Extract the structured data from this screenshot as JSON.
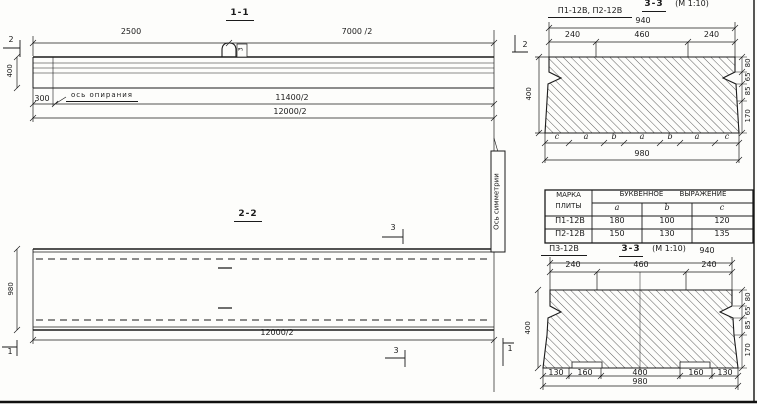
{
  "colors": {
    "ink": "#1b1b1b",
    "paper": "#fdfdfb"
  },
  "s11": {
    "title": "1-1",
    "marker_left": "2",
    "marker_right": "2",
    "dim_2500": "2500",
    "dim_7000": "7000 /2",
    "loop_tag": "3",
    "dim_400": "400",
    "dim_300": "300",
    "bearing_label": "ось опирания",
    "dim_11400": "11400/2",
    "dim_12000": "12000/2"
  },
  "s22": {
    "title": "2-2",
    "marker_3_top": "3",
    "marker_3_bottom": "3",
    "marker_1_left": "1",
    "marker_1_right": "1",
    "dim_980": "980",
    "dim_12000": "12000/2",
    "symmetry_label": "Ось симметрии"
  },
  "s33a": {
    "label": "П1-12В, П2-12В",
    "title": "3-3",
    "scale": "(М 1:10)",
    "dim_940": "940",
    "top_dims": [
      "240",
      "460",
      "240"
    ],
    "dim_400": "400",
    "right_dims": [
      "80",
      "65",
      "85",
      "170"
    ],
    "letters": [
      "c",
      "a",
      "b",
      "a",
      "b",
      "a",
      "c"
    ],
    "dim_980": "980"
  },
  "table": {
    "h_mark_1": "МАРКА",
    "h_mark_2": "ПЛИТЫ",
    "h_expr": "БУКВЕННОЕ ВЫРАЖЕНИЕ",
    "cols": [
      "a",
      "b",
      "c"
    ],
    "rows": [
      {
        "mark": "П1-12В",
        "a": "180",
        "b": "100",
        "c": "120"
      },
      {
        "mark": "П2-12В",
        "a": "150",
        "b": "130",
        "c": "135"
      }
    ]
  },
  "s33b": {
    "label": "П3-12В",
    "title": "3-3",
    "scale": "(М 1:10)",
    "dim_940": "940",
    "top_dims": [
      "240",
      "460",
      "240"
    ],
    "dim_400": "400",
    "right_dims": [
      "80",
      "65",
      "85",
      "170"
    ],
    "bottom_dims": [
      "130",
      "160",
      "400",
      "160",
      "130"
    ],
    "dim_980": "980"
  }
}
